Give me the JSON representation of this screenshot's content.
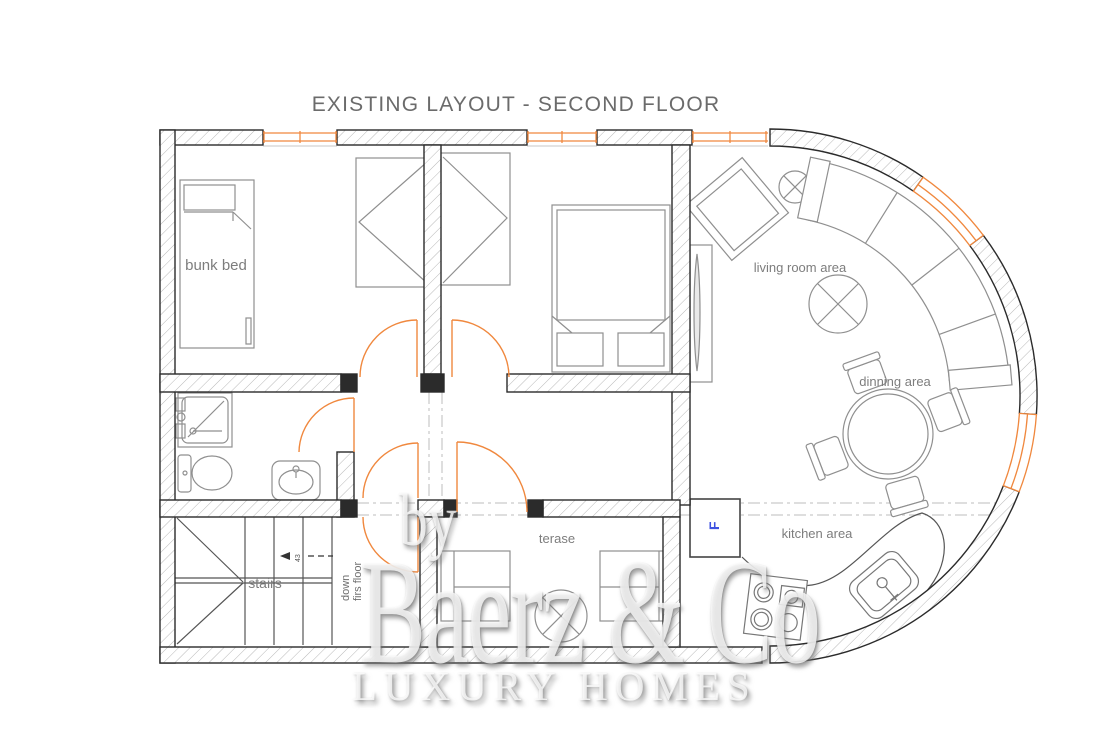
{
  "title": "EXISTING LAYOUT - SECOND FLOOR",
  "colors": {
    "accent_orange": "#F0883E",
    "wall_outline": "#2B2B2B",
    "hatch_line": "#B8B8B8",
    "furniture_line": "#8F8F8F",
    "label_gray": "#7D7D7D",
    "fridge_blue": "#3D52E0",
    "dash_gray": "#C9C9C9"
  },
  "rooms": {
    "bunk_room": {
      "label": "bunk bed"
    },
    "living_room": {
      "label": "living room area"
    },
    "dining": {
      "label": "dinning area"
    },
    "kitchen": {
      "label": "kitchen area",
      "fridge_label": "F"
    },
    "terrace": {
      "label": "terase"
    },
    "stairs": {
      "label": "stairs",
      "note_line1": "down",
      "note_line2": "firs floor",
      "mark": "43"
    }
  },
  "watermark": {
    "by": "by",
    "brand": "Baerz & Co",
    "tagline": "LUXURY HOMES"
  }
}
